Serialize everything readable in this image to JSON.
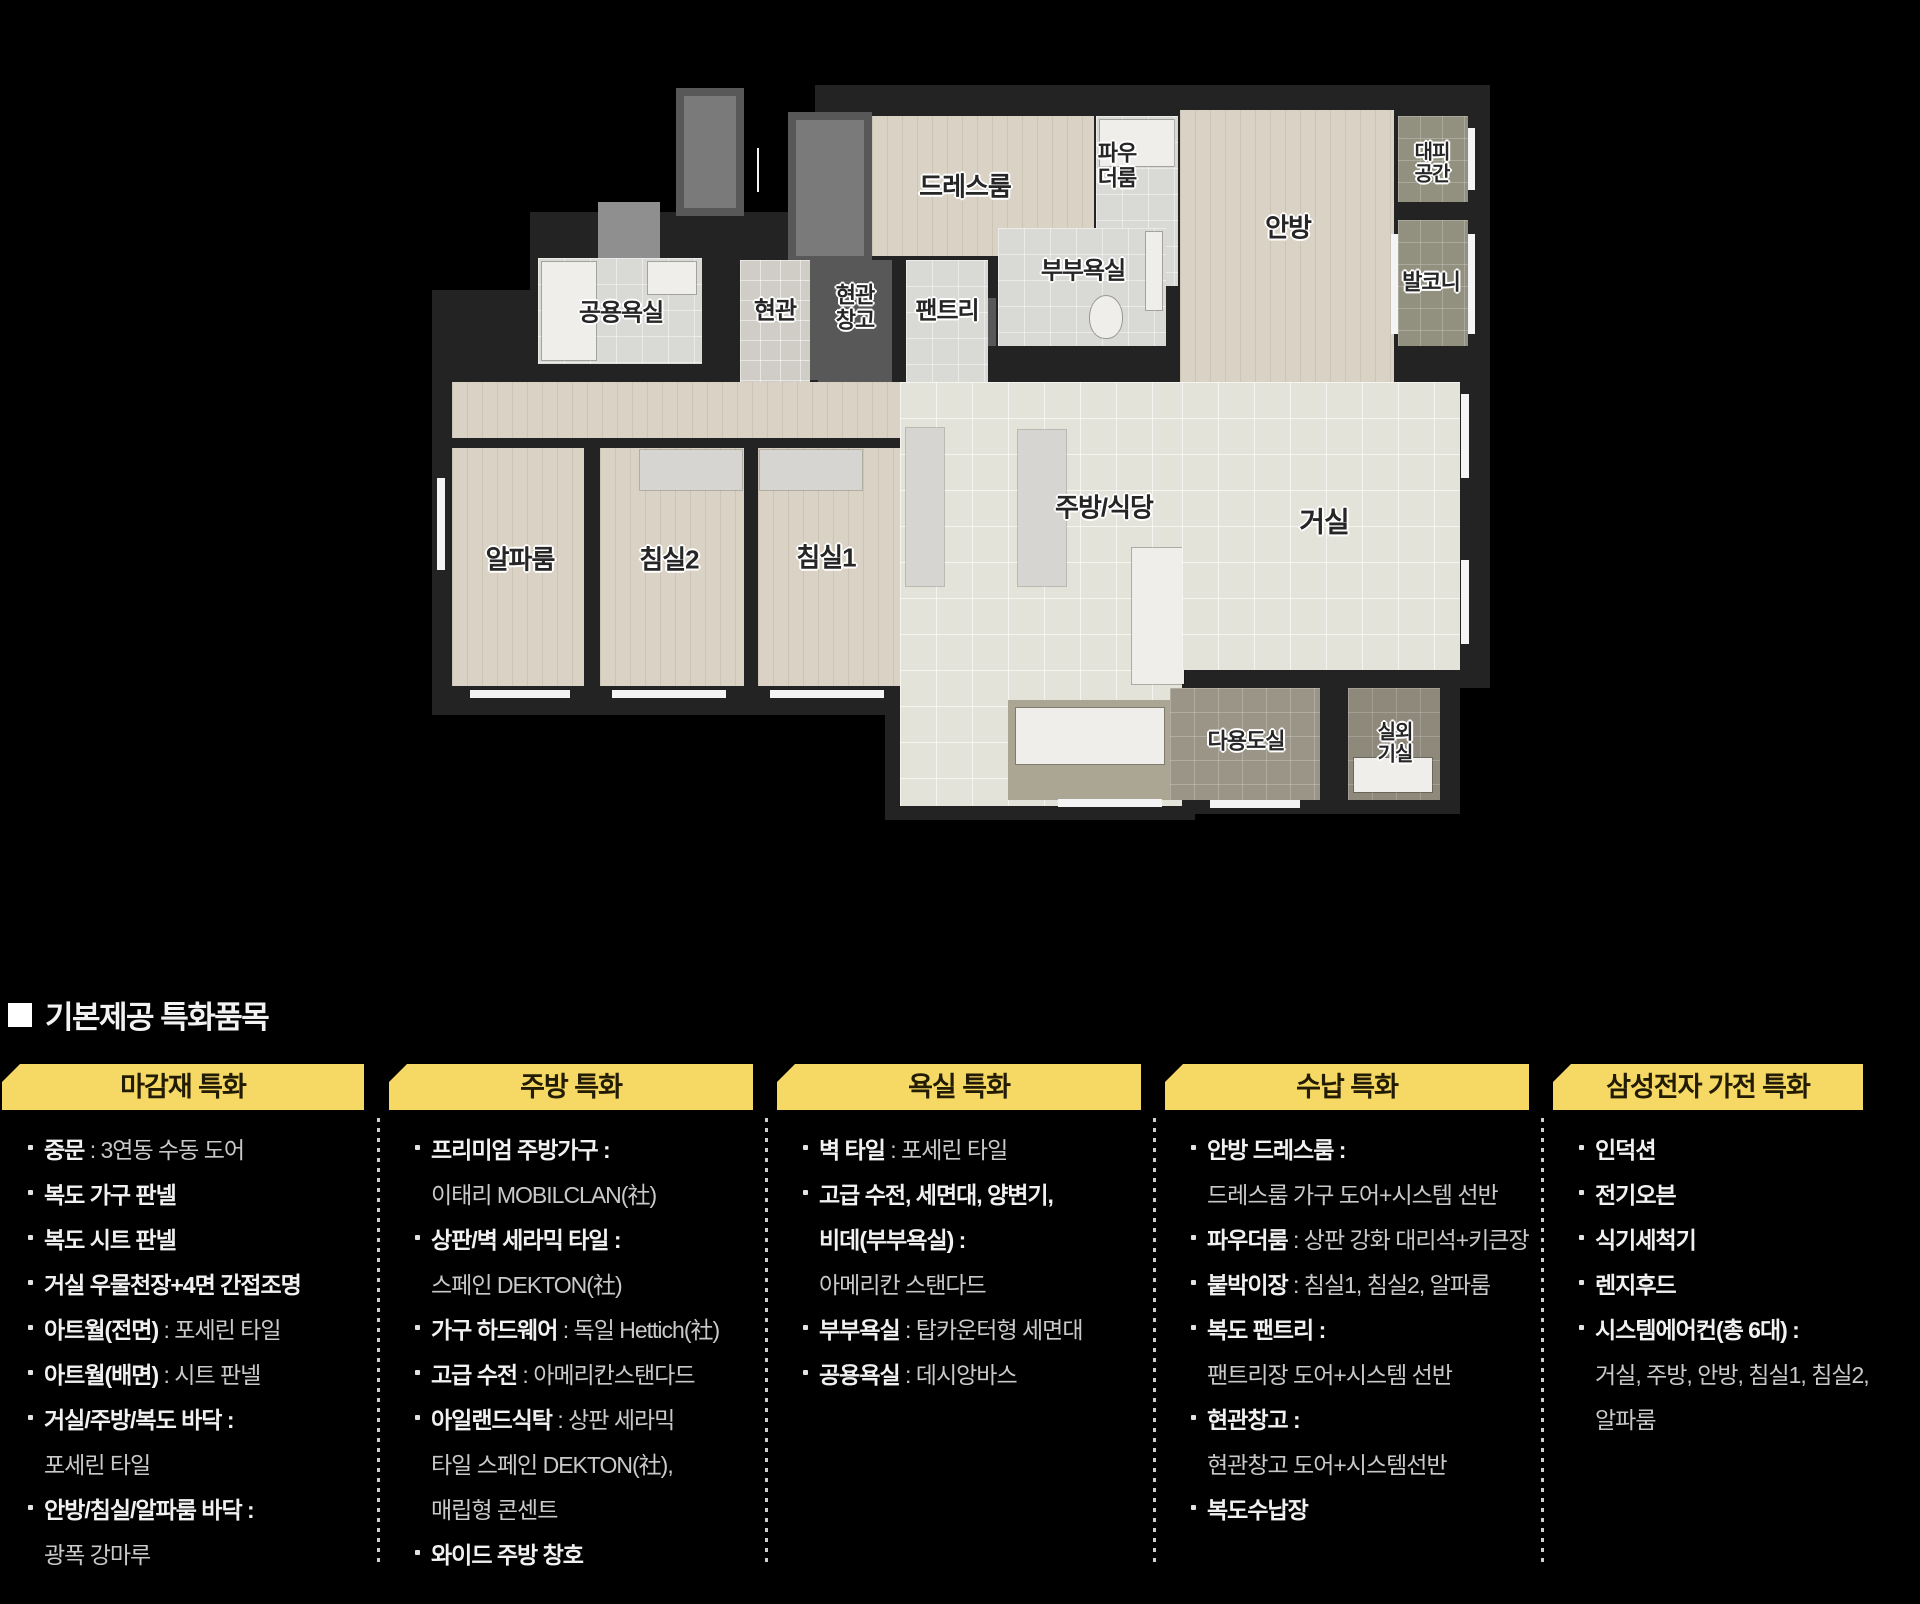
{
  "page": {
    "width": 1920,
    "height": 1604
  },
  "palette": {
    "bg": "#000000",
    "wall": "#232323",
    "wood": "#dad3c5",
    "tile": "#e4e3da",
    "bath": "#d9d9d5",
    "balcony": "#92907e",
    "utility": "#9a9587",
    "outdoor": "#8e897b",
    "closet": "#585858",
    "closetLight": "#7a7a7a",
    "counter": "#d6d5d1",
    "white": "#efeeea",
    "window": "#f4f4f4",
    "taupe": "#aba593",
    "gray": "#8f8f8f",
    "label": "#262626",
    "headerBg": "#f6d964",
    "headerText": "#221c04",
    "textBold": "#f1f1f1",
    "textNormal": "#c9c9c9",
    "divider": "#cfcfcf"
  },
  "floor_plan": {
    "shapes": [
      {
        "n": "wall-top-block",
        "c": "wall",
        "x": 815,
        "y": 85,
        "w": 675,
        "h": 300
      },
      {
        "n": "wall-entry-strip",
        "c": "wall",
        "x": 530,
        "y": 212,
        "w": 432,
        "h": 173
      },
      {
        "n": "wall-left-step",
        "c": "wall",
        "x": 432,
        "y": 290,
        "w": 108,
        "h": 95
      },
      {
        "n": "wall-bedroom-zone",
        "c": "wall",
        "x": 432,
        "y": 370,
        "w": 478,
        "h": 345
      },
      {
        "n": "wall-kitchen-zone",
        "c": "wall",
        "x": 885,
        "y": 370,
        "w": 310,
        "h": 450
      },
      {
        "n": "wall-living-zone",
        "c": "wall",
        "x": 1170,
        "y": 370,
        "w": 320,
        "h": 318
      },
      {
        "n": "wall-utility-zone",
        "c": "wall",
        "x": 1158,
        "y": 658,
        "w": 302,
        "h": 156
      },
      {
        "n": "core-shaft",
        "c": "closet",
        "x": 676,
        "y": 88,
        "w": 68,
        "h": 128
      },
      {
        "n": "core-shaft-inner",
        "c": "closetLight",
        "x": 684,
        "y": 96,
        "w": 52,
        "h": 112
      },
      {
        "n": "entry-vestibule",
        "c": "gray",
        "x": 598,
        "y": 202,
        "w": 62,
        "h": 56
      },
      {
        "n": "entry-arrow-line",
        "c": "window",
        "x": 757,
        "y": 148,
        "w": 2,
        "h": 44
      },
      {
        "n": "dressroom-closet",
        "c": "closet",
        "x": 788,
        "y": 112,
        "w": 84,
        "h": 268
      },
      {
        "n": "dressroom-closet-inner",
        "c": "closetLight",
        "x": 796,
        "y": 120,
        "w": 68,
        "h": 136
      },
      {
        "n": "dressroom-floor",
        "c": "wood",
        "x": 872,
        "y": 116,
        "w": 222,
        "h": 140
      },
      {
        "n": "powder-room-floor",
        "c": "bath",
        "x": 1096,
        "y": 116,
        "w": 82,
        "h": 170
      },
      {
        "n": "powder-room-counter",
        "c": "white",
        "x": 1100,
        "y": 120,
        "w": 74,
        "h": 46
      },
      {
        "n": "master-bedroom-floor",
        "c": "wood",
        "x": 1180,
        "y": 110,
        "w": 214,
        "h": 272
      },
      {
        "n": "shelter-floor",
        "c": "balcony",
        "x": 1398,
        "y": 116,
        "w": 70,
        "h": 86
      },
      {
        "n": "balcony-floor",
        "c": "balcony",
        "x": 1398,
        "y": 220,
        "w": 70,
        "h": 126
      },
      {
        "n": "window",
        "c": "window",
        "x": 1468,
        "y": 128,
        "w": 7,
        "h": 62
      },
      {
        "n": "window",
        "c": "window",
        "x": 1468,
        "y": 234,
        "w": 7,
        "h": 100
      },
      {
        "n": "window",
        "c": "window",
        "x": 1391,
        "y": 234,
        "w": 7,
        "h": 100
      },
      {
        "n": "master-bath-floor",
        "c": "bath",
        "x": 998,
        "y": 228,
        "w": 168,
        "h": 118
      },
      {
        "n": "master-bath-counter",
        "c": "white",
        "x": 1146,
        "y": 232,
        "w": 16,
        "h": 78
      },
      {
        "n": "toilet",
        "c": "toilet",
        "x": 1090,
        "y": 296,
        "w": 32,
        "h": 42
      },
      {
        "n": "bath-closet",
        "c": "closet",
        "x": 952,
        "y": 298,
        "w": 44,
        "h": 48
      },
      {
        "n": "common-bath-floor",
        "c": "bath",
        "x": 538,
        "y": 258,
        "w": 164,
        "h": 106
      },
      {
        "n": "bathtub",
        "c": "white",
        "x": 542,
        "y": 262,
        "w": 54,
        "h": 98
      },
      {
        "n": "wash-basin",
        "c": "white",
        "x": 648,
        "y": 262,
        "w": 48,
        "h": 32
      },
      {
        "n": "entrance-floor",
        "c": "tileSm",
        "x": 740,
        "y": 260,
        "w": 70,
        "h": 122
      },
      {
        "n": "entrance-storage-floor",
        "c": "closet",
        "x": 818,
        "y": 260,
        "w": 74,
        "h": 122
      },
      {
        "n": "pantry-floor",
        "c": "bath",
        "x": 906,
        "y": 260,
        "w": 82,
        "h": 122
      },
      {
        "n": "corridor-floor",
        "c": "wood",
        "x": 452,
        "y": 382,
        "w": 730,
        "h": 56
      },
      {
        "n": "alpha-room-floor",
        "c": "wood",
        "x": 452,
        "y": 448,
        "w": 132,
        "h": 238
      },
      {
        "n": "bedroom2-floor",
        "c": "wood",
        "x": 600,
        "y": 448,
        "w": 144,
        "h": 238
      },
      {
        "n": "bedroom2-closet",
        "c": "counter",
        "x": 640,
        "y": 450,
        "w": 102,
        "h": 40
      },
      {
        "n": "bedroom1-floor",
        "c": "wood",
        "x": 758,
        "y": 448,
        "w": 144,
        "h": 238
      },
      {
        "n": "bedroom1-closet",
        "c": "counter",
        "x": 760,
        "y": 450,
        "w": 102,
        "h": 40
      },
      {
        "n": "kitchen-floor",
        "c": "tile",
        "x": 900,
        "y": 382,
        "w": 282,
        "h": 424
      },
      {
        "n": "kitchen-tall-unit",
        "c": "counter",
        "x": 906,
        "y": 428,
        "w": 38,
        "h": 158
      },
      {
        "n": "kitchen-counter-left",
        "c": "counter",
        "x": 1018,
        "y": 430,
        "w": 48,
        "h": 156
      },
      {
        "n": "kitchen-island",
        "c": "white",
        "x": 1132,
        "y": 548,
        "w": 52,
        "h": 136
      },
      {
        "n": "kitchen-counter-bottom",
        "c": "taupe",
        "x": 1008,
        "y": 700,
        "w": 164,
        "h": 100
      },
      {
        "n": "kitchen-sink-counter",
        "c": "white",
        "x": 1016,
        "y": 708,
        "w": 148,
        "h": 56
      },
      {
        "n": "window",
        "c": "window",
        "x": 1058,
        "y": 799,
        "w": 104,
        "h": 8
      },
      {
        "n": "living-room-floor",
        "c": "tile",
        "x": 1182,
        "y": 382,
        "w": 278,
        "h": 288
      },
      {
        "n": "window",
        "c": "window",
        "x": 1461,
        "y": 394,
        "w": 8,
        "h": 84
      },
      {
        "n": "window",
        "c": "window",
        "x": 1461,
        "y": 560,
        "w": 8,
        "h": 84
      },
      {
        "n": "window",
        "c": "window",
        "x": 437,
        "y": 478,
        "w": 8,
        "h": 92
      },
      {
        "n": "window",
        "c": "window",
        "x": 470,
        "y": 690,
        "w": 100,
        "h": 8
      },
      {
        "n": "window",
        "c": "window",
        "x": 612,
        "y": 690,
        "w": 114,
        "h": 8
      },
      {
        "n": "window",
        "c": "window",
        "x": 770,
        "y": 690,
        "w": 114,
        "h": 8
      },
      {
        "n": "utility-room-floor",
        "c": "utility",
        "x": 1170,
        "y": 688,
        "w": 150,
        "h": 112
      },
      {
        "n": "outdoor-unit-room-floor",
        "c": "outdoor",
        "x": 1348,
        "y": 688,
        "w": 92,
        "h": 112
      },
      {
        "n": "outdoor-unit",
        "c": "white",
        "x": 1354,
        "y": 758,
        "w": 78,
        "h": 34
      },
      {
        "n": "window",
        "c": "window",
        "x": 1210,
        "y": 800,
        "w": 90,
        "h": 8
      }
    ],
    "labels": [
      {
        "n": "label-dressroom",
        "text": "드레스룸",
        "x": 965,
        "y": 187,
        "s": 26
      },
      {
        "n": "label-powder-room",
        "text": "파우\n더룸",
        "x": 1117,
        "y": 166,
        "s": 22
      },
      {
        "n": "label-master-bedroom",
        "text": "안방",
        "x": 1288,
        "y": 228,
        "s": 26
      },
      {
        "n": "label-shelter",
        "text": "대피\n공간",
        "x": 1432,
        "y": 164,
        "s": 20
      },
      {
        "n": "label-balcony",
        "text": "발코니",
        "x": 1431,
        "y": 283,
        "s": 22
      },
      {
        "n": "label-common-bath",
        "text": "공용욕실",
        "x": 621,
        "y": 314,
        "s": 24
      },
      {
        "n": "label-entrance",
        "text": "현관",
        "x": 775,
        "y": 312,
        "s": 24
      },
      {
        "n": "label-entrance-storage",
        "text": "현관\n창고",
        "x": 855,
        "y": 308,
        "s": 22
      },
      {
        "n": "label-pantry",
        "text": "팬트리",
        "x": 947,
        "y": 312,
        "s": 24
      },
      {
        "n": "label-master-bath",
        "text": "부부욕실",
        "x": 1083,
        "y": 272,
        "s": 24
      },
      {
        "n": "label-alpha-room",
        "text": "알파룸",
        "x": 520,
        "y": 560,
        "s": 26
      },
      {
        "n": "label-bedroom2",
        "text": "침실2",
        "x": 669,
        "y": 560,
        "s": 26
      },
      {
        "n": "label-bedroom1",
        "text": "침실1",
        "x": 826,
        "y": 558,
        "s": 26
      },
      {
        "n": "label-kitchen-dining",
        "text": "주방/식당",
        "x": 1104,
        "y": 508,
        "s": 26
      },
      {
        "n": "label-living-room",
        "text": "거실",
        "x": 1324,
        "y": 522,
        "s": 28
      },
      {
        "n": "label-utility-room",
        "text": "다용도실",
        "x": 1246,
        "y": 742,
        "s": 22
      },
      {
        "n": "label-outdoor-unit-room",
        "text": "실외\n기실",
        "x": 1395,
        "y": 744,
        "s": 20
      }
    ]
  },
  "section": {
    "title": "기본제공 특화품목",
    "divider_x": [
      377,
      765,
      1153,
      1541
    ],
    "line_top0": 1125,
    "line_step": 45,
    "columns": [
      {
        "key": "finishing",
        "header": "마감재 특화",
        "bar_x": 2,
        "bar_w": 362,
        "lines": [
          {
            "bullet": true,
            "b": "중문",
            "n": " : 3연동 수동 도어"
          },
          {
            "bullet": true,
            "b": "복도 가구 판넬",
            "n": ""
          },
          {
            "bullet": true,
            "b": "복도 시트 판넬",
            "n": ""
          },
          {
            "bullet": true,
            "b": "거실 우물천장+4면 간접조명",
            "n": ""
          },
          {
            "bullet": true,
            "b": "아트월(전면)",
            "n": " : 포세린 타일"
          },
          {
            "bullet": true,
            "b": "아트월(배면)",
            "n": " : 시트 판넬"
          },
          {
            "bullet": true,
            "b": "거실/주방/복도 바닥 :",
            "n": ""
          },
          {
            "bullet": false,
            "b": "",
            "n": "포세린 타일"
          },
          {
            "bullet": true,
            "b": "안방/침실/알파룸 바닥 :",
            "n": ""
          },
          {
            "bullet": false,
            "b": "",
            "n": "광폭 강마루"
          }
        ]
      },
      {
        "key": "kitchen",
        "header": "주방 특화",
        "bar_x": 389,
        "bar_w": 364,
        "lines": [
          {
            "bullet": true,
            "b": "프리미엄 주방가구 :",
            "n": ""
          },
          {
            "bullet": false,
            "b": "",
            "n": "이태리 MOBILCLAN(社)"
          },
          {
            "bullet": true,
            "b": "상판/벽 세라믹 타일 :",
            "n": ""
          },
          {
            "bullet": false,
            "b": "",
            "n": "스페인 DEKTON(社)"
          },
          {
            "bullet": true,
            "b": "가구 하드웨어",
            "n": " : 독일 Hettich(社)"
          },
          {
            "bullet": true,
            "b": "고급 수전",
            "n": " : 아메리칸스탠다드"
          },
          {
            "bullet": true,
            "b": "아일랜드식탁",
            "n": " : 상판 세라믹"
          },
          {
            "bullet": false,
            "b": "",
            "n": "타일 스페인 DEKTON(社),"
          },
          {
            "bullet": false,
            "b": "",
            "n": "매립형 콘센트"
          },
          {
            "bullet": true,
            "b": "와이드 주방 창호",
            "n": ""
          }
        ]
      },
      {
        "key": "bathroom",
        "header": "욕실 특화",
        "bar_x": 777,
        "bar_w": 364,
        "lines": [
          {
            "bullet": true,
            "b": "벽 타일",
            "n": " : 포세린 타일"
          },
          {
            "bullet": true,
            "b": "고급 수전, 세면대, 양변기,",
            "n": ""
          },
          {
            "bullet": false,
            "b": "비데(부부욕실) :",
            "n": ""
          },
          {
            "bullet": false,
            "b": "",
            "n": "아메리칸 스탠다드"
          },
          {
            "bullet": true,
            "b": "부부욕실",
            "n": " : 탑카운터형 세면대"
          },
          {
            "bullet": true,
            "b": "공용욕실",
            "n": " : 데시앙바스"
          }
        ]
      },
      {
        "key": "storage",
        "header": "수납 특화",
        "bar_x": 1165,
        "bar_w": 364,
        "lines": [
          {
            "bullet": true,
            "b": "안방 드레스룸 :",
            "n": ""
          },
          {
            "bullet": false,
            "b": "",
            "n": "드레스룸 가구 도어+시스템 선반"
          },
          {
            "bullet": true,
            "b": "파우더룸",
            "n": " : 상판 강화 대리석+키큰장"
          },
          {
            "bullet": true,
            "b": "붙박이장",
            "n": " : 침실1, 침실2, 알파룸"
          },
          {
            "bullet": true,
            "b": "복도 팬트리 :",
            "n": ""
          },
          {
            "bullet": false,
            "b": "",
            "n": "팬트리장 도어+시스템 선반"
          },
          {
            "bullet": true,
            "b": "현관창고 :",
            "n": ""
          },
          {
            "bullet": false,
            "b": "",
            "n": "현관창고 도어+시스템선반"
          },
          {
            "bullet": true,
            "b": "복도수납장",
            "n": ""
          }
        ]
      },
      {
        "key": "appliance",
        "header": "삼성전자 가전 특화",
        "bar_x": 1553,
        "bar_w": 310,
        "lines": [
          {
            "bullet": true,
            "b": "인덕션",
            "n": ""
          },
          {
            "bullet": true,
            "b": "전기오븐",
            "n": ""
          },
          {
            "bullet": true,
            "b": "식기세척기",
            "n": ""
          },
          {
            "bullet": true,
            "b": "렌지후드",
            "n": ""
          },
          {
            "bullet": true,
            "b": "시스템에어컨(총 6대) :",
            "n": ""
          },
          {
            "bullet": false,
            "b": "",
            "n": "거실, 주방, 안방, 침실1, 침실2,"
          },
          {
            "bullet": false,
            "b": "",
            "n": "알파룸"
          }
        ]
      }
    ]
  }
}
